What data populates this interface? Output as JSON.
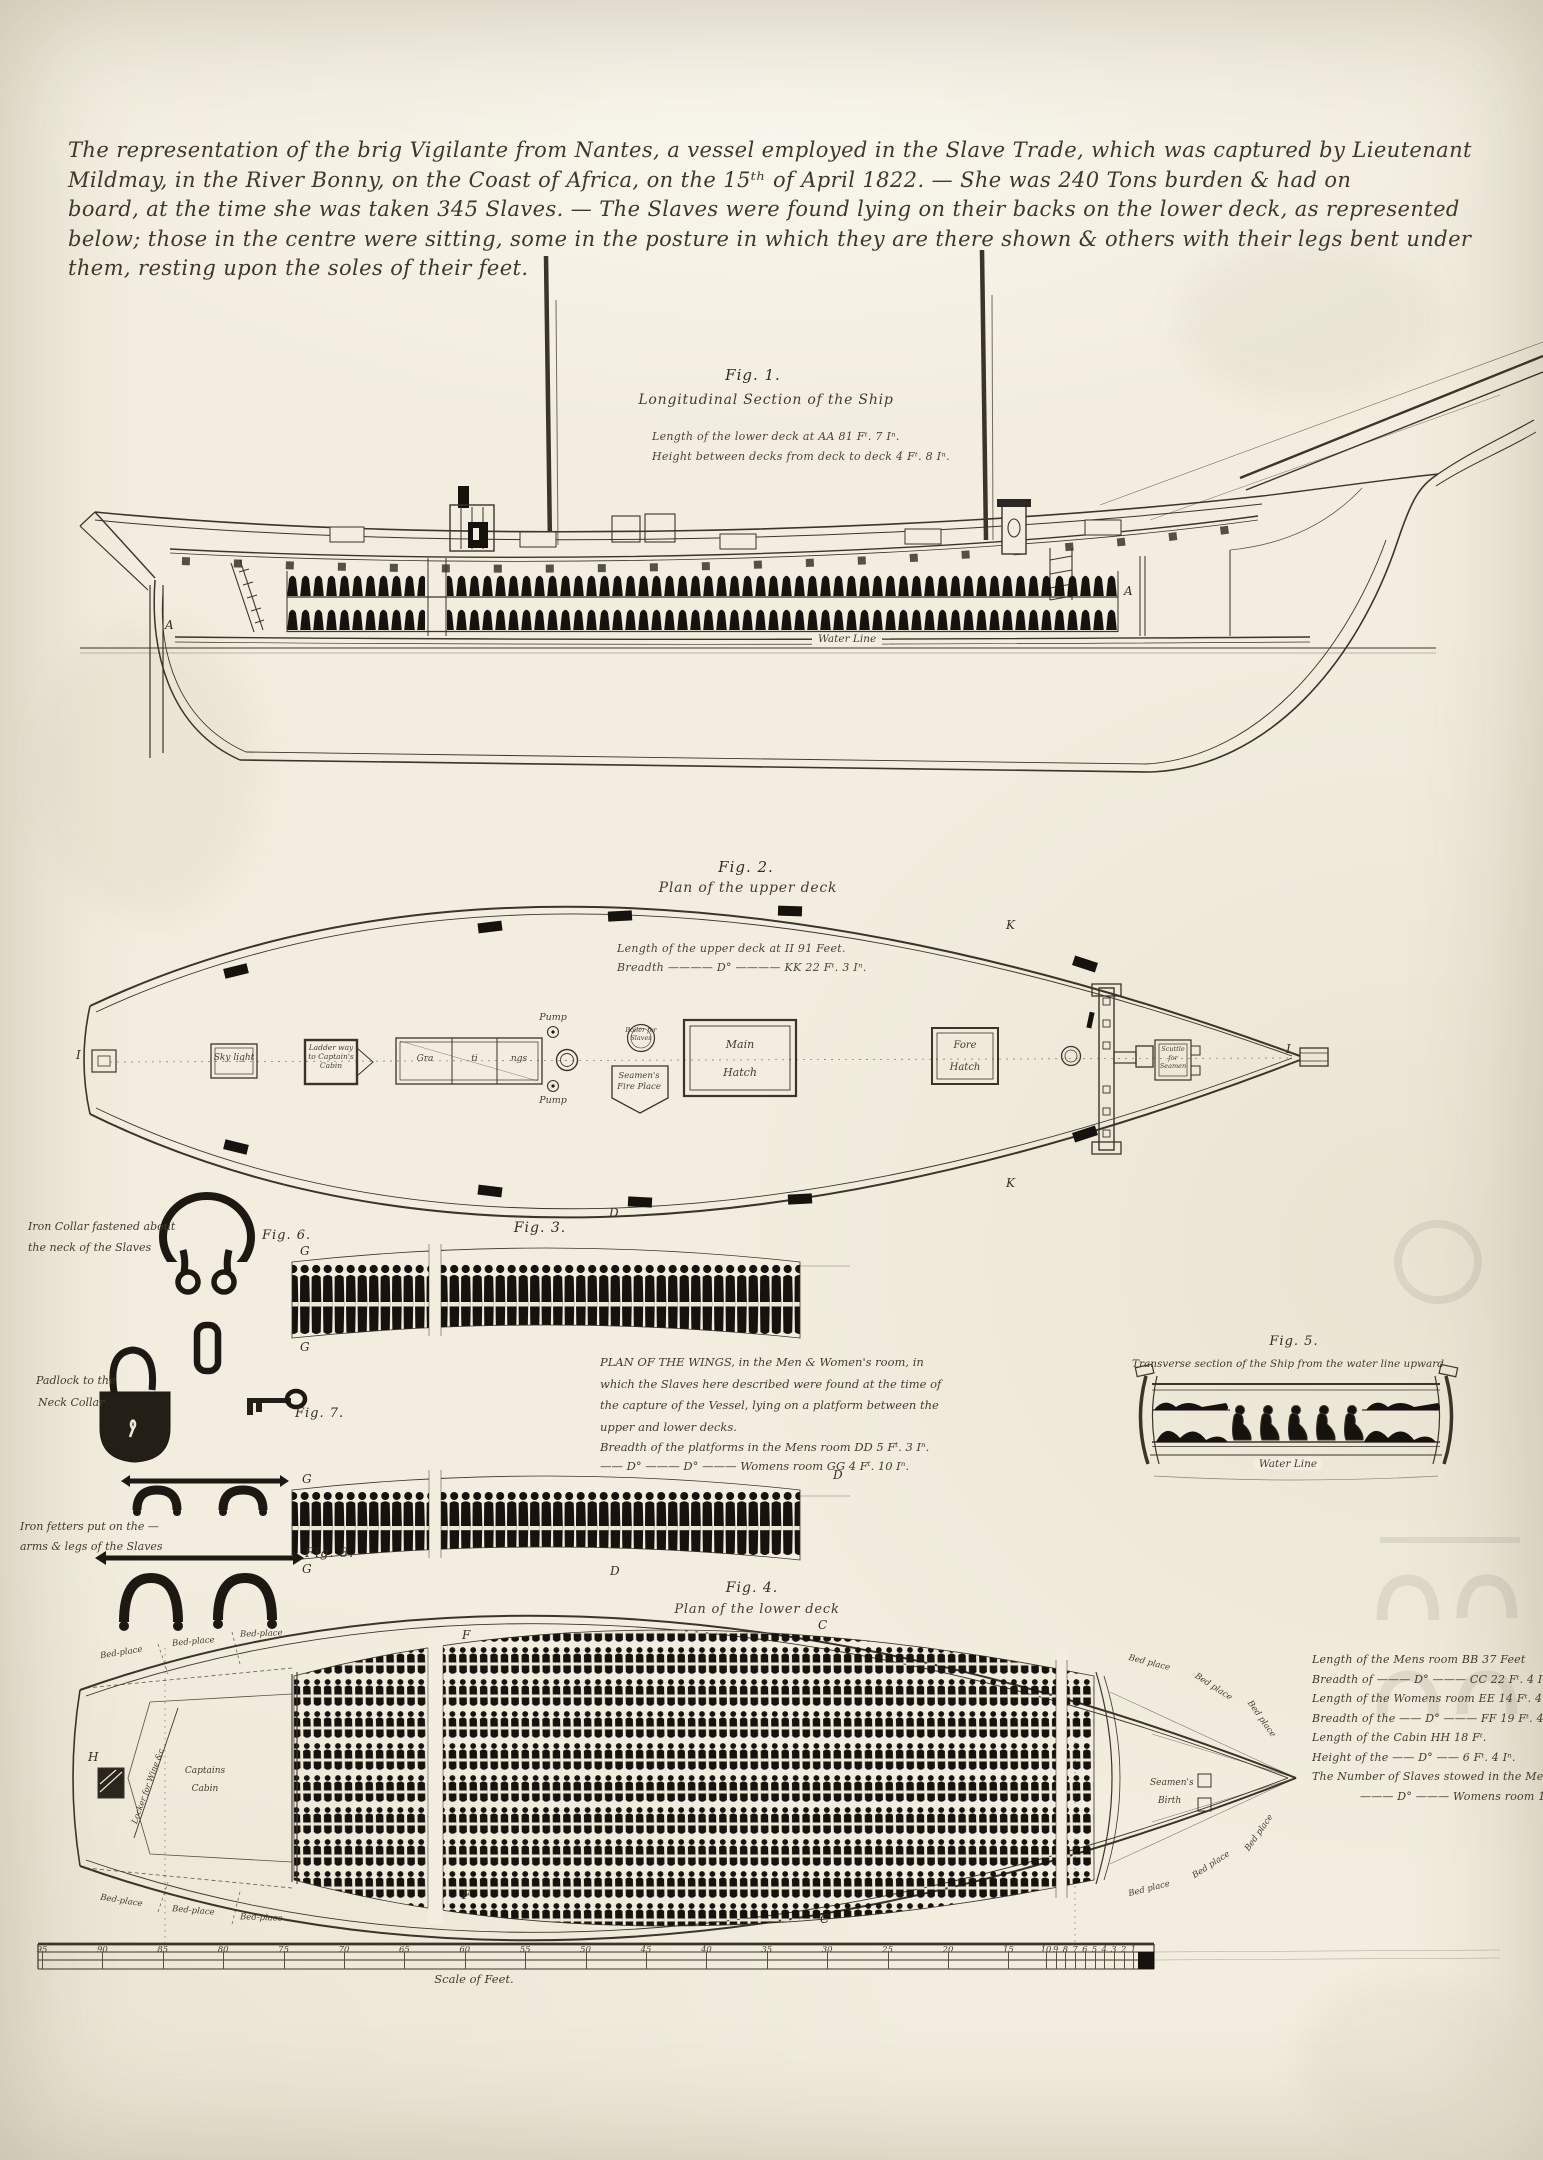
{
  "header": {
    "lines": [
      "The representation of the brig Vigilante from Nantes, a vessel employed in the Slave Trade, which was captured by Lieutenant",
      "Mildmay, in the River Bonny, on the Coast of Africa, on the 15ᵗʰ of April 1822. — She was 240 Tons burden & had on",
      "board, at the time she was taken 345 Slaves. — The Slaves were found lying on their backs on the lower deck, as represented",
      "below; those in the centre were sitting, some in the posture in which they are there shown & others with their legs bent under",
      "them, resting upon the soles of their feet."
    ]
  },
  "fig1": {
    "label": "Fig. 1.",
    "title": "Longitudinal Section of the Ship",
    "note1": "Length of the lower deck at AA 81 Fᵗ. 7 Iⁿ.",
    "note2": "Height between decks from deck to deck 4 Fᵗ. 8 Iⁿ.",
    "water_line": "Water Line",
    "mark_a": "A"
  },
  "fig2": {
    "label": "Fig. 2.",
    "title": "Plan of the upper deck",
    "note1": "Length of the upper deck at II 91 Feet.",
    "note2": "Breadth ———— D° ———— KK 22 Fᵗ. 3 Iⁿ.",
    "sky_light": "Sky light",
    "ladder_way": "Ladder way to Captain's Cabin",
    "gratings": [
      "Gra",
      "ti",
      "ngs"
    ],
    "pump": "Pump",
    "boiler": "Boiler for Slaves",
    "seamens_fire_place": "Seamen's Fire Place",
    "main_hatch": [
      "Main",
      "Hatch"
    ],
    "fore_hatch": [
      "Fore",
      "Hatch"
    ],
    "scuttle": "Scuttle for Seamen",
    "mark_k": "K",
    "mark_i": "I"
  },
  "fig3": {
    "label": "Fig. 3.",
    "text_lines": [
      "PLAN OF THE WINGS, in the Men & Women's room, in",
      "which the Slaves here described were found at the time of",
      "the capture of the Vessel, lying on a platform between the",
      "upper and lower decks.",
      "Breadth of the platforms in the Mens room DD 5 Fᵗ. 3 Iⁿ.",
      "—— D° ——— D° ——— Womens room GG 4 Fᵗ. 10 Iⁿ."
    ],
    "mark_d": "D",
    "mark_g": "G"
  },
  "fig4": {
    "label": "Fig. 4.",
    "title": "Plan of the lower deck",
    "bed_place_left": "Bed-place",
    "bed_place_right": "Bed place",
    "captains_cabin": [
      "Captains",
      "Cabin"
    ],
    "locker": "Locker for Wine &c",
    "seamens_birth": [
      "Seamen's",
      "Birth"
    ],
    "mark_c": "C",
    "mark_f": "F",
    "mark_h": "H"
  },
  "fig5": {
    "label": "Fig. 5.",
    "title": "Transverse section of the Ship from the water line upward",
    "water_line": "Water Line"
  },
  "fig6": {
    "label": "Fig. 6.",
    "caption_lines": [
      "Iron Collar fastened about",
      "the neck of the Slaves"
    ]
  },
  "fig7": {
    "label": "Fig. 7.",
    "caption_lines": [
      "Padlock to the",
      "Neck Collar"
    ]
  },
  "fig8": {
    "label": "Fig. 8.",
    "caption_lines": [
      "Iron fetters put on the —",
      "arms & legs of the Slaves"
    ]
  },
  "measurements": {
    "lines": [
      "Length of the Mens room BB 37 Feet",
      "Breadth of ——— D° ——— CC 22 Fᵗ. 4 Iⁿ.",
      "Length of the Womens room EE 14 Fᵗ. 4 Iⁿ.",
      "Breadth of the —— D° ——— FF 19 Fᵗ. 4 Iⁿ.",
      "Length of the Cabin HH 18 Fᵗ.",
      "Height of the —— D° —— 6 Fᵗ. 4 Iⁿ.",
      "The Number of Slaves stowed in the Mens room 227",
      "——— D° ——— Womens room 118"
    ]
  },
  "scale": {
    "caption": "Scale of Feet.",
    "major_labels": [
      "95",
      "90",
      "85",
      "80",
      "75",
      "70",
      "65",
      "60",
      "55",
      "50",
      "45",
      "40",
      "35",
      "30",
      "25",
      "20",
      "15"
    ],
    "minor_labels": [
      "10",
      "9",
      "8",
      "7",
      "6",
      "5",
      "4",
      "3",
      "2",
      "1"
    ]
  }
}
